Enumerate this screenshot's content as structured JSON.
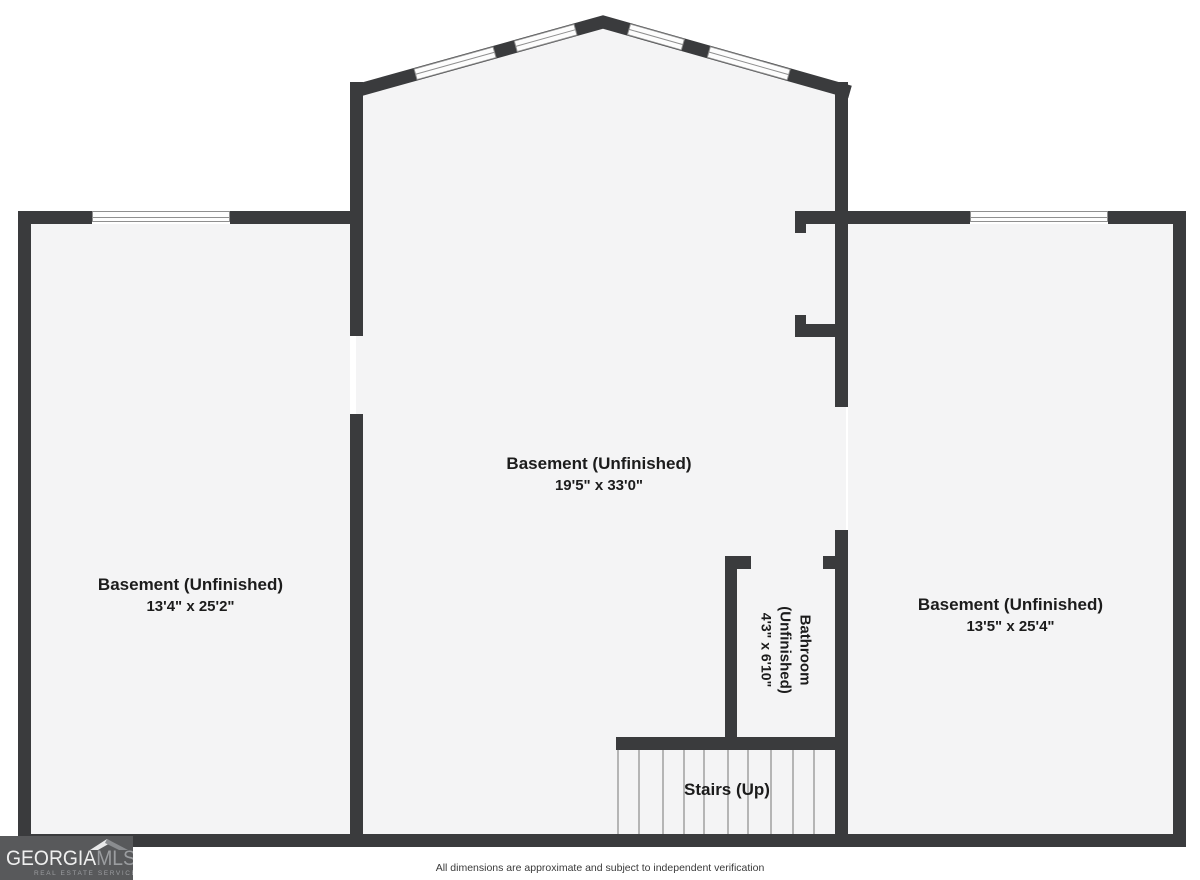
{
  "rooms": {
    "left": {
      "name": "Basement (Unfinished)",
      "dims": "13'4\" x 25'2\""
    },
    "center": {
      "name": "Basement (Unfinished)",
      "dims": "19'5\" x 33'0\""
    },
    "right": {
      "name": "Basement (Unfinished)",
      "dims": "13'5\" x 25'4\""
    },
    "bathroom": {
      "name": "Bathroom (Unfinished)",
      "dims": "4'3\" x 6'10\""
    },
    "stairs": {
      "name": "Stairs (Up)"
    }
  },
  "footer": {
    "disclaimer": "All dimensions are approximate and subject to independent verification"
  },
  "logo": {
    "brand_primary": "GEORGIA",
    "brand_secondary": "MLS",
    "tagline": "REAL ESTATE SERVICES"
  },
  "colors": {
    "wall": "#3a3b3d",
    "floor": "#f4f4f5",
    "window_fill": "#fdfdfd",
    "window_line": "#8f8f8f",
    "tread": "#b5b5b5",
    "text": "#1c1c1c",
    "footer_text": "#3a3a3a",
    "logo_bg": "#58595b",
    "logo_primary": "#efefef",
    "logo_secondary": "#9b9da0"
  }
}
